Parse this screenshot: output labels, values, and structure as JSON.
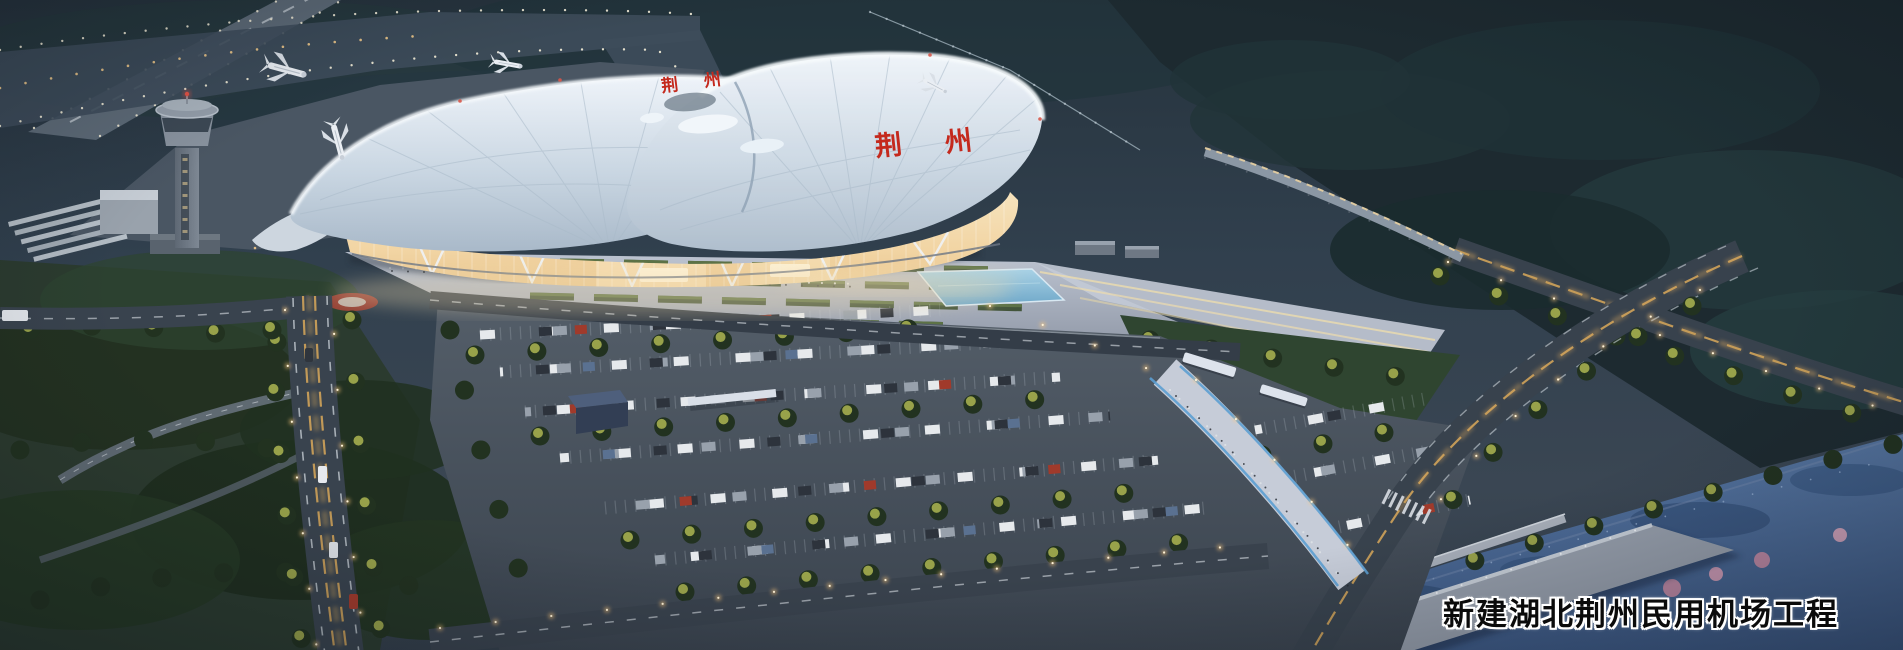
{
  "caption": {
    "text": "新建湖北荆州民用机场工程"
  },
  "terminal": {
    "roof_sign_char_1": "荆",
    "roof_sign_char_2": "州",
    "far_sign": "荆州",
    "sign_color": "#c4291d"
  },
  "colors": {
    "dusk_base": "#2c3a47",
    "airfield_grass": "#27343e",
    "taxiway": "#3e4d5b",
    "roof_light": "#eef3f9",
    "roof_shade": "#a9b9c9",
    "glass_glow_top": "#f6e3bd",
    "glass_glow_bottom": "#e9c690",
    "plaza": "#b6bdca",
    "asphalt": "#49525e",
    "tree_dark": "#223220",
    "tree_lit": "#9fa94d",
    "pool_blue": "#8fc2dc",
    "water_top": "#55749f",
    "water_bottom": "#3e5a86",
    "street_glow": "#d8a757",
    "caption_fill": "#0b0b0b",
    "caption_outline": "#ffffff"
  }
}
